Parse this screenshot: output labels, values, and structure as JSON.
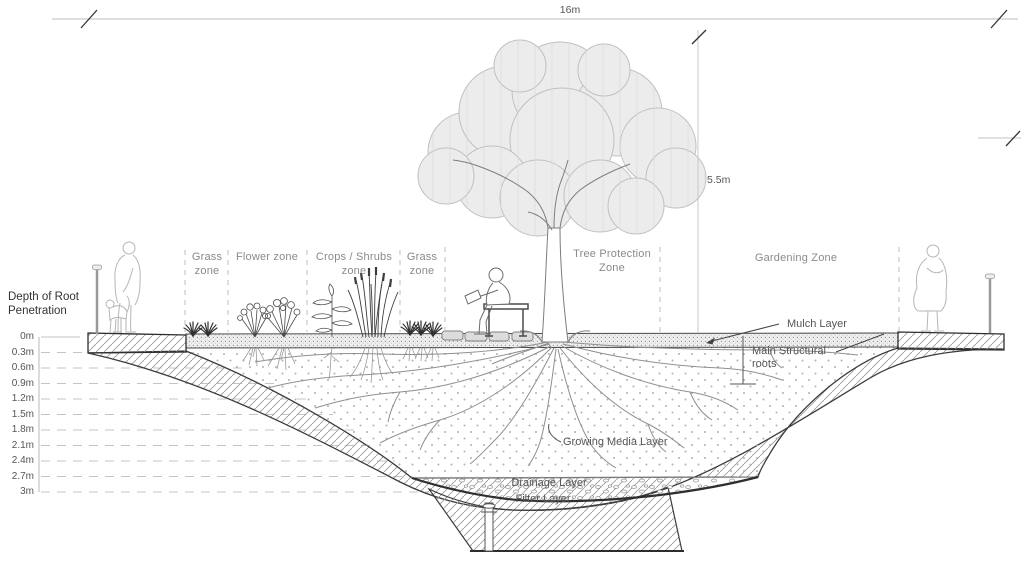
{
  "dimensions": {
    "width_label": "16m",
    "height_label": "5.5m"
  },
  "depth_scale": {
    "title": "Depth of Root\nPenetration",
    "ticks": [
      "0m",
      "0.3m",
      "0.6m",
      "0.9m",
      "1.2m",
      "1.5m",
      "1.8m",
      "2.1m",
      "2.4m",
      "2.7m",
      "3m"
    ]
  },
  "zones": [
    {
      "label": "Grass\nzone"
    },
    {
      "label": "Flower zone"
    },
    {
      "label": "Crops / Shrubs\nzone"
    },
    {
      "label": "Grass\nzone"
    },
    {
      "label": "Tree Protection\nZone"
    },
    {
      "label": "Gardening Zone"
    }
  ],
  "layers": {
    "mulch": "Mulch Layer",
    "structural_roots": "Main Structural\nroots",
    "growing_media": "Growing Media Layer",
    "drainage": "Drainage Layer",
    "filter": "Filter Layer"
  },
  "colors": {
    "linework": "#3d3d3d",
    "light_figures": "#b5b5b5",
    "dashed_guides": "#c4c4c4",
    "canopy_fill": "#ececec"
  }
}
